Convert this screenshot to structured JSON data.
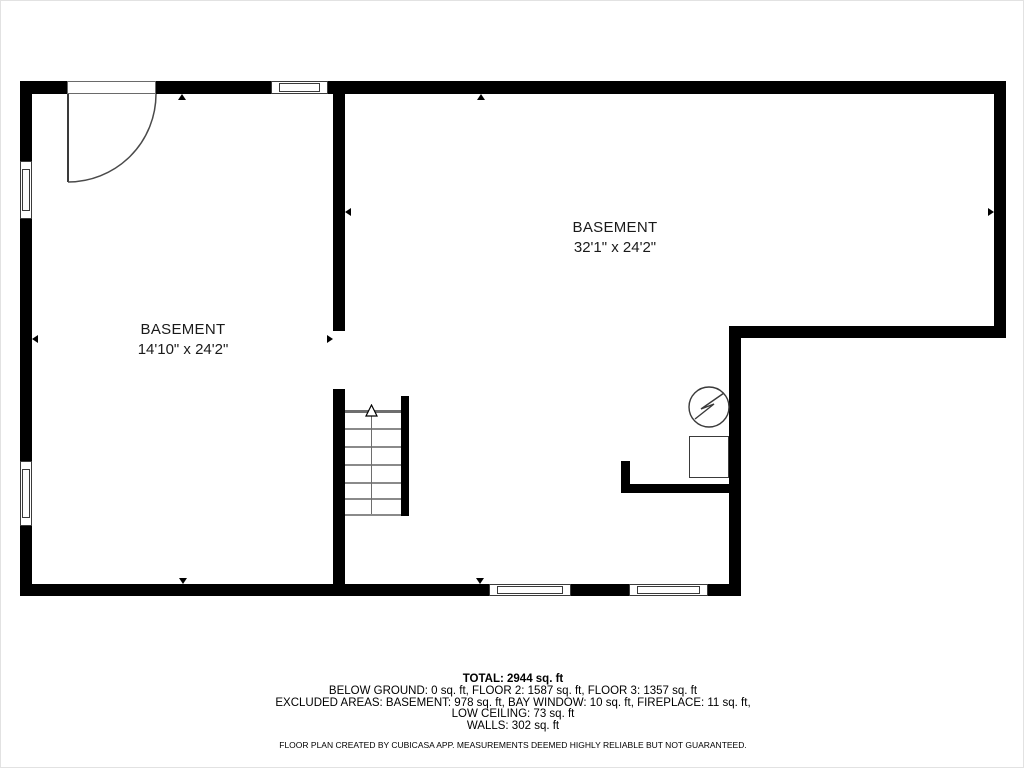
{
  "plan": {
    "rooms": [
      {
        "name": "BASEMENT",
        "dimensions": "14'10\" x 24'2\""
      },
      {
        "name": "BASEMENT",
        "dimensions": "32'1\" x 24'2\""
      }
    ],
    "icons": {
      "door": "door-swing-icon",
      "window": "window-icon",
      "stairs": "staircase-up-arrow-icon",
      "appliance": "water-heater-bolt-icon",
      "dimension_marker": "dimension-arrow-icon"
    },
    "colors": {
      "wall": "#000000",
      "background": "#ffffff",
      "stair_line": "#8a8a8a",
      "border": "#e2e2e2"
    }
  },
  "summary": {
    "total": "TOTAL: 2944 sq. ft",
    "line1": "BELOW GROUND: 0 sq. ft, FLOOR 2: 1587 sq. ft, FLOOR 3: 1357 sq. ft",
    "line2": "EXCLUDED AREAS: BASEMENT: 978 sq. ft, BAY WINDOW: 10 sq. ft, FIREPLACE: 11 sq. ft,",
    "line3": "LOW CEILING: 73 sq. ft",
    "line4": "WALLS: 302 sq. ft",
    "disclaimer": "FLOOR PLAN CREATED BY CUBICASA APP. MEASUREMENTS DEEMED HIGHLY RELIABLE BUT NOT GUARANTEED."
  }
}
